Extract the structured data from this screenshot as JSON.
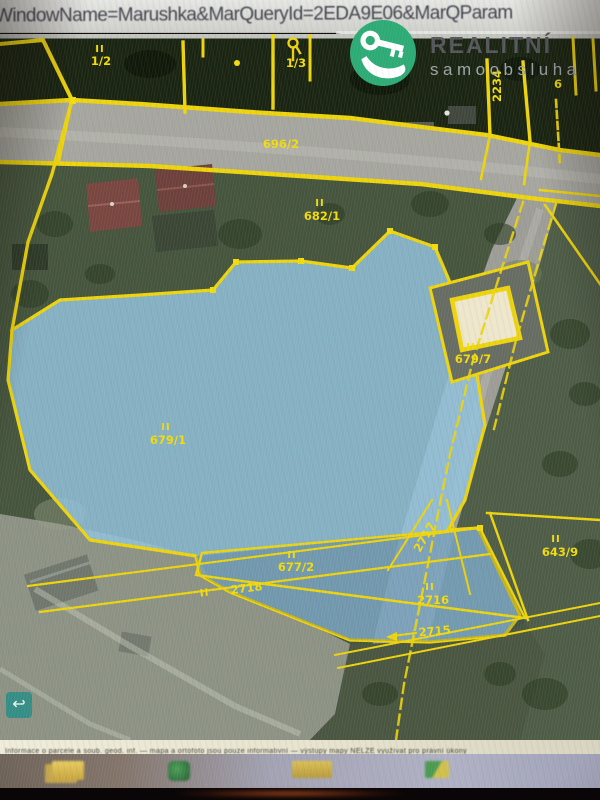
{
  "address_bar": {
    "text": "WindowName=Marushka&MarQueryId=2EDA9E06&MarQParam"
  },
  "logo": {
    "brand": "REALITNÍ",
    "subtitle": "samoobsluha",
    "brand_color": "#2cab74"
  },
  "map": {
    "marker": "II",
    "boundary_color": "#f0d400",
    "highlight_color": "#8fc2dd",
    "labels": {
      "parcel_1_2": "1/2",
      "parcel_1_3": "1/3",
      "parcel_2234": "2234",
      "parcel_6": "6",
      "parcel_696_2": "696/2",
      "parcel_682_1": "682/1",
      "parcel_679_1": "679/1",
      "parcel_679_7": "679/7",
      "parcel_677_2": "677/2",
      "parcel_2718": "2718",
      "parcel_2717": "2717",
      "parcel_2716": "2716",
      "parcel_2715": "2715",
      "parcel_643_9": "643/9"
    },
    "controls": {
      "back_arrow": "↩"
    }
  },
  "attribution": {
    "text": "Informace o parcele a soub. geod. inf. — mapa a ortofoto jsou pouze informativní — výstupy mapy NELZE využívat pro právní úkony"
  },
  "taskbar": {
    "icons": [
      "folders-icon",
      "app-green-icon",
      "folder-wide-icon",
      "app-small-icon"
    ]
  }
}
